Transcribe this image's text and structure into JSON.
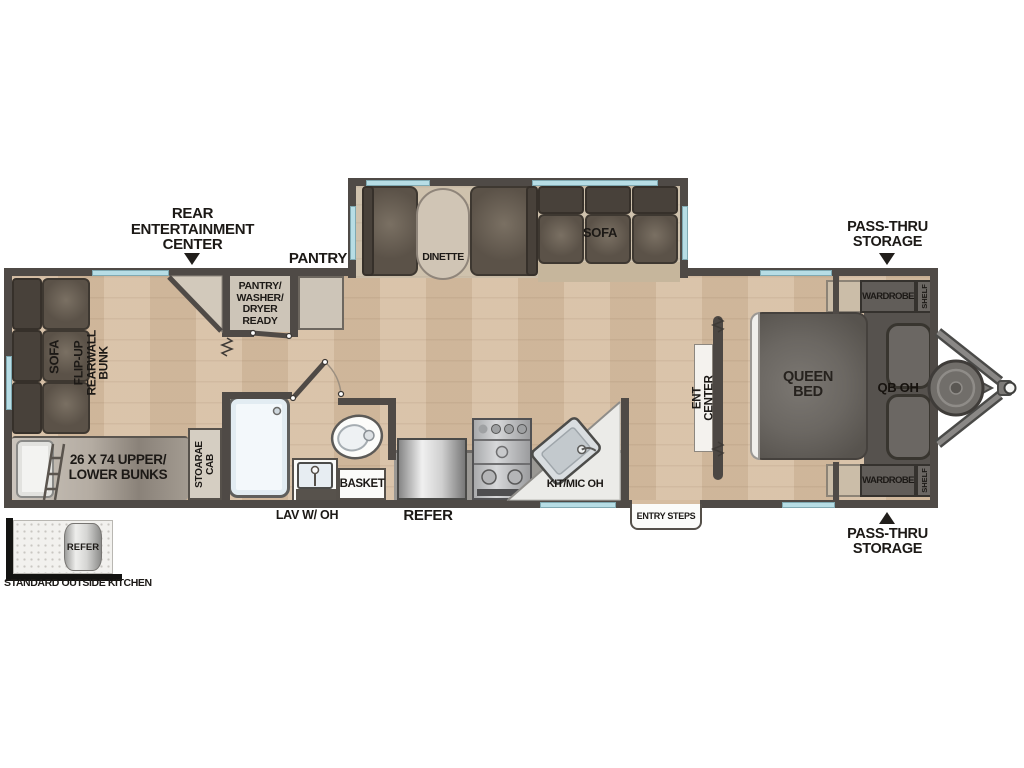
{
  "colors": {
    "wall": "#4f4a46",
    "window": "#b7dde5",
    "floor": "#d6bda1",
    "slideout_floor": "#cfc2ad",
    "cushion": "#5b5248",
    "cabinet": "#cdc5b8",
    "label_ink": "#1c1916"
  },
  "callouts": {
    "rear_entertainment_center": "REAR\nENTERTAINMENT\nCENTER",
    "pantry": "PANTRY",
    "pass_thru_storage_top": "PASS-THRU\nSTORAGE",
    "pass_thru_storage_bottom": "PASS-THRU\nSTORAGE"
  },
  "slideout": {
    "dinette": "DINETTE",
    "sofa": "SOFA"
  },
  "rear": {
    "sofa": "SOFA",
    "flip_up_bunk": "FLIP-UP REARWALL BUNK",
    "bunks": "26 X 74 UPPER/\nLOWER BUNKS",
    "storage_cab": "STOARAE\nCAB"
  },
  "utility": {
    "pantry_closet": "PANTRY/\nWASHER/\nDRYER\nREADY"
  },
  "bath": {
    "lav": "LAV W/ OH",
    "basket": "BASKET"
  },
  "kitchen": {
    "refer": "REFER",
    "kit_mic_oh": "KIT/MIC OH",
    "entry_steps": "ENTRY STEPS"
  },
  "bedroom": {
    "queen_bed": "QUEEN\nBED",
    "qb_oh": "QB OH",
    "ent_center": "ENT CENTER",
    "wardrobe_top": "WARDROBE",
    "shelf_top": "SHELF",
    "wardrobe_bottom": "WARDROBE",
    "shelf_bottom": "SHELF"
  },
  "outside_kitchen": {
    "refer": "REFER",
    "caption": "STANDARD OUTSIDE KITCHEN"
  }
}
